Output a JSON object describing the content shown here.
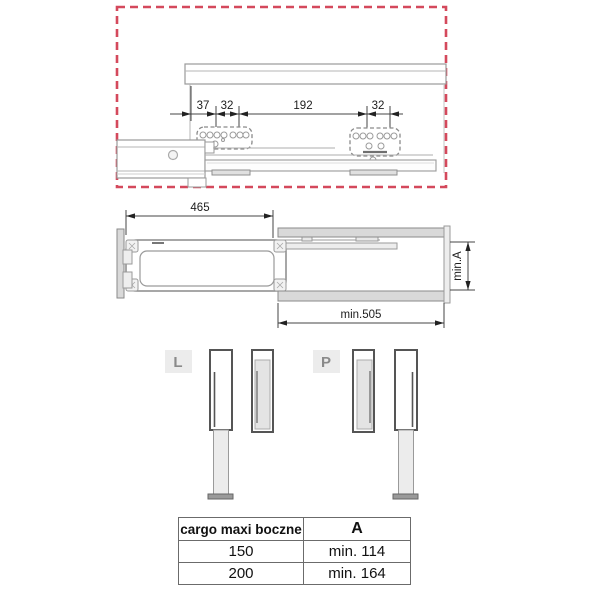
{
  "colors": {
    "dashed_border": "#d4495c",
    "line": "#8a8a8a"
  },
  "top_view": {
    "dims": [
      "37",
      "32",
      "192",
      "32"
    ]
  },
  "side_view": {
    "width_label": "465",
    "depth_label": "min.505",
    "height_label": "min.A"
  },
  "rails": {
    "left_label": "L",
    "right_label": "P"
  },
  "table": {
    "headers": [
      "cargo maxi boczne",
      "A"
    ],
    "rows": [
      [
        "150",
        "min. 114"
      ],
      [
        "200",
        "min. 164"
      ]
    ]
  }
}
